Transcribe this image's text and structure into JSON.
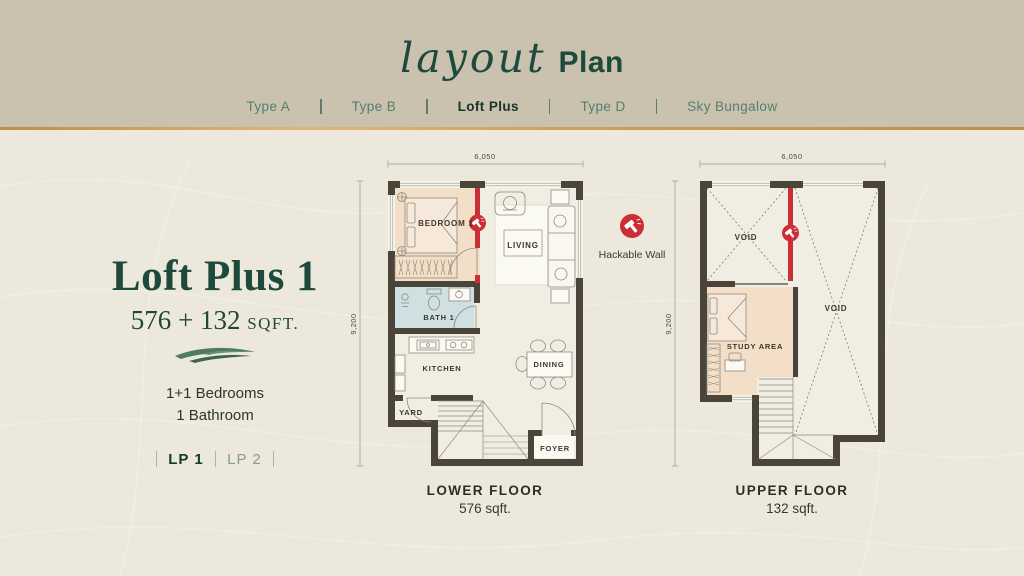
{
  "header": {
    "title_script": "layout",
    "title_rest": "Plan",
    "tabs": [
      {
        "label": "Type A",
        "active": false
      },
      {
        "label": "Type B",
        "active": false
      },
      {
        "label": "Loft Plus",
        "active": true
      },
      {
        "label": "Type D",
        "active": false
      },
      {
        "label": "Sky Bungalow",
        "active": false
      }
    ]
  },
  "info": {
    "unit_name": "Loft Plus 1",
    "area_text": "576 + 132",
    "area_unit": "SQFT.",
    "bedrooms": "1+1 Bedrooms",
    "bathrooms": "1 Bathroom",
    "variants": [
      {
        "label": "LP 1",
        "active": true
      },
      {
        "label": "LP 2",
        "active": false
      }
    ]
  },
  "legend": {
    "icon": "hammer-icon",
    "label": "Hackable Wall"
  },
  "lower_plan": {
    "dim_width": "6,050",
    "dim_height": "9,200",
    "rooms": {
      "bedroom": "BEDROOM 1",
      "living": "LIVING",
      "bath": "BATH 1",
      "kitchen": "KITCHEN",
      "dining": "DINING",
      "yard": "YARD",
      "foyer": "FOYER"
    },
    "caption": {
      "title": "LOWER FLOOR",
      "area": "576 sqft."
    }
  },
  "upper_plan": {
    "dim_width": "6,050",
    "dim_height": "9,200",
    "rooms": {
      "void_left": "VOID",
      "void_right": "VOID",
      "study": "STUDY AREA"
    },
    "caption": {
      "title": "UPPER FLOOR",
      "area": "132 sqft."
    }
  },
  "colors": {
    "accent_red": "#cb2e35",
    "gold": "#c7a35c",
    "deep_green": "#1c4a3d",
    "wall": "#4a4538",
    "bedroom_fill": "#f3dec7",
    "bath_fill": "#cfe0e2",
    "header_bg": "#cac1ae",
    "page_bg": "#ece9dc"
  }
}
